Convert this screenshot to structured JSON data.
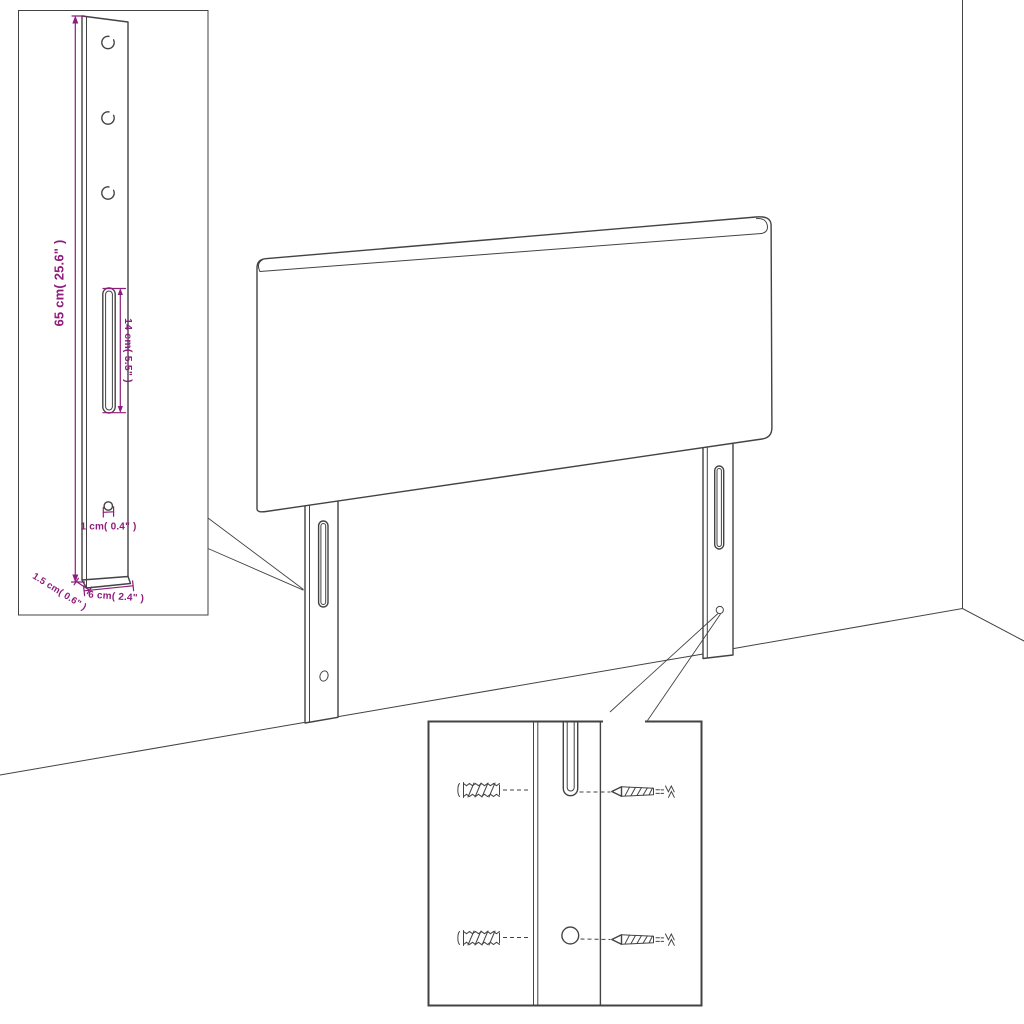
{
  "colors": {
    "background": "#ffffff",
    "line": "#434343",
    "dimension_text": "#8E1C7C"
  },
  "bracket_inset": {
    "labels": {
      "height": "65 cm( 25.6\" )",
      "slot": "14 cm( 5.5\" )",
      "hole": "1 cm( 0.4\" )",
      "thickness": "1.5 cm( 0.6\" )",
      "depth": "6 cm( 2.4\" )"
    }
  },
  "mounting_inset": {
    "icons": [
      {
        "name": "wall-plug-icon"
      },
      {
        "name": "screw-icon"
      }
    ]
  }
}
